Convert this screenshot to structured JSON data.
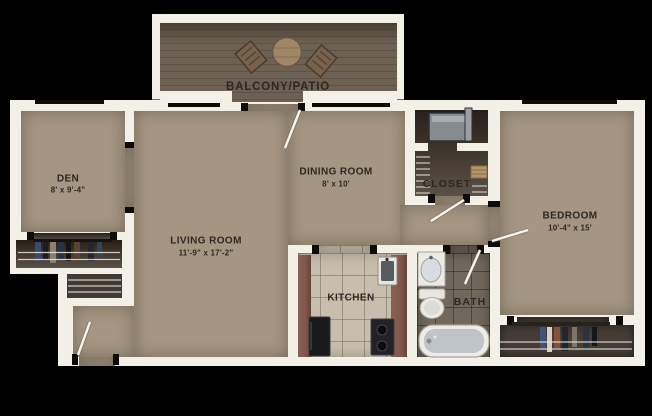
{
  "plan_title": "apartment-floor-plan",
  "rooms": {
    "balcony": {
      "name": "BALCONY/PATIO"
    },
    "den": {
      "name": "DEN",
      "dims": "8' x 9'-4\""
    },
    "dining": {
      "name": "DINING ROOM",
      "dims": "8' x 10'"
    },
    "living": {
      "name": "LIVING ROOM",
      "dims": "11'-9\" x 17'-2\""
    },
    "closet": {
      "name": "CLOSET"
    },
    "bedroom": {
      "name": "BEDROOM",
      "dims": "10'-4\" x 15'"
    },
    "kitchen": {
      "name": "KITCHEN"
    },
    "bath": {
      "name": "BATH"
    }
  },
  "colors": {
    "wall": "#f3f0e8",
    "carpet": "#a49682",
    "deck": "#6d6153",
    "deck_line": "#5c5245",
    "closet_dark": "#5a5148",
    "closet_mid": "#453d35",
    "linen": "#423b33",
    "kitchen_tile": "#c7beae",
    "bath_tile": "#71685c",
    "counter": "#7f5849",
    "ink": "#2d2823",
    "background": "#000000"
  }
}
